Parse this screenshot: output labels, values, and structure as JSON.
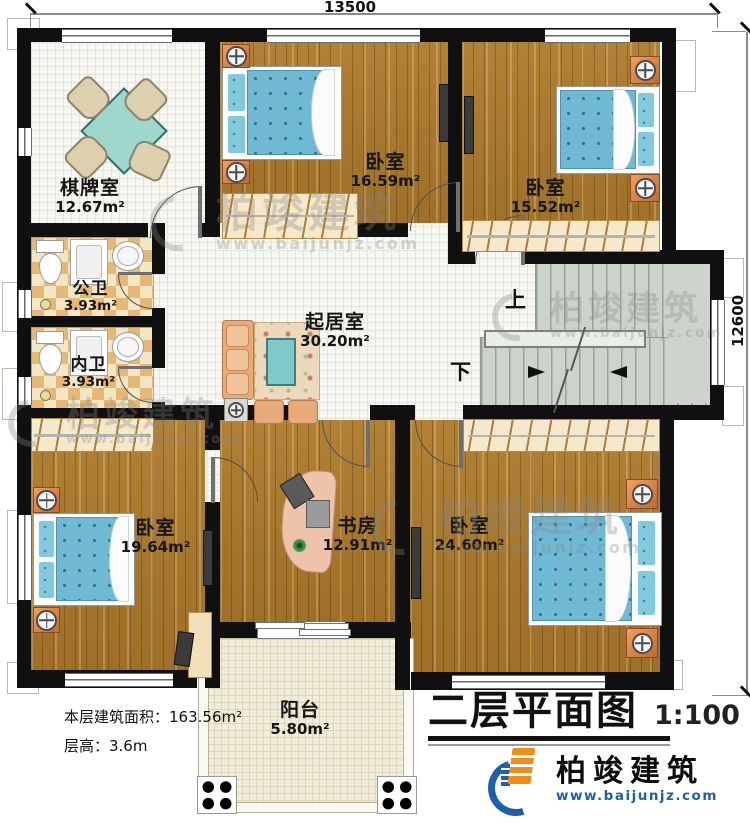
{
  "dims": {
    "width_label": "13500",
    "height_label": "12600"
  },
  "rooms": {
    "chess": {
      "name": "棋牌室",
      "area": "12.67m²"
    },
    "bedroom_top_mid": {
      "name": "卧室",
      "area": "16.59m²"
    },
    "bedroom_top_right": {
      "name": "卧室",
      "area": "15.52m²"
    },
    "public_bath": {
      "name": "公卫",
      "area": "3.93m²"
    },
    "private_bath": {
      "name": "内卫",
      "area": "3.93m²"
    },
    "living": {
      "name": "起居室",
      "area": "30.20m²"
    },
    "bedroom_bottom_left": {
      "name": "卧室",
      "area": "19.64m²"
    },
    "study": {
      "name": "书房",
      "area": "12.91m²"
    },
    "bedroom_bottom_right": {
      "name": "卧室",
      "area": "24.60m²"
    },
    "balcony": {
      "name": "阳台",
      "area": "5.80m²"
    }
  },
  "stairs": {
    "up_label": "上",
    "down_label": "下"
  },
  "notes": {
    "floor_area": "本层建筑面积：163.56m²",
    "floor_height": "层高：3.6m"
  },
  "title": {
    "name": "二层平面图",
    "scale": "1:100"
  },
  "brand": {
    "name": "柏竣建筑",
    "website": "www.baijunjz.com"
  },
  "watermark": {
    "name": "柏竣建筑",
    "website": "www.baijunjz.com"
  },
  "colors": {
    "wall": "#101010",
    "wood_floor": "#a9792f",
    "tile_floor": "#f6f6f2",
    "bath_floor": "#e4b877",
    "stair_floor": "#ccd3ca",
    "balcony_floor": "#f1eddb",
    "bed_blue": "#6fb9d4",
    "nightstand_orange": "#d9813f",
    "brand_blue": "#1d5fa8",
    "brand_orange": "#ef8c1c"
  }
}
